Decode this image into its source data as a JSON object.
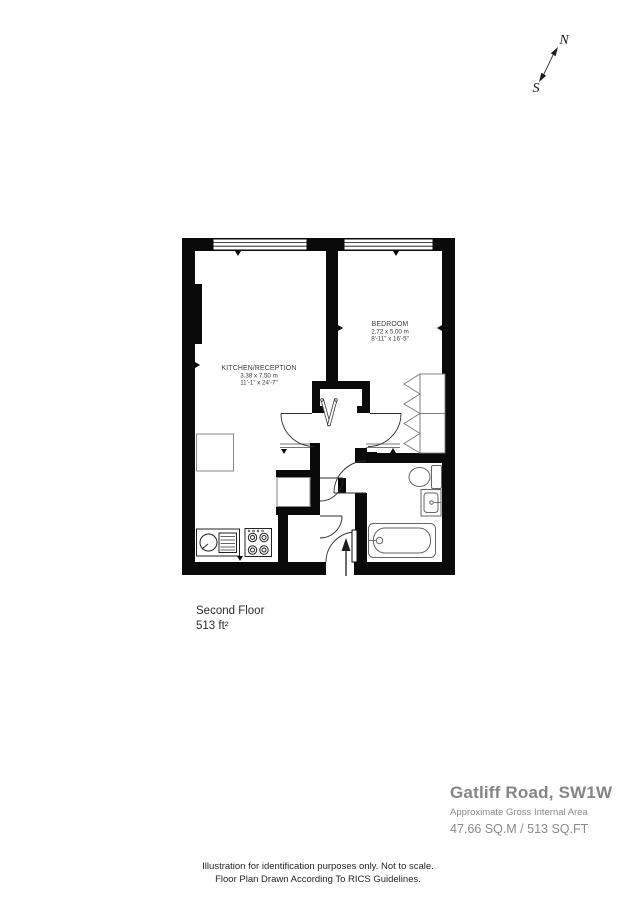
{
  "compass": {
    "north": "N",
    "south": "S"
  },
  "plan": {
    "rooms": [
      {
        "name": "KITCHEN/RECEPTION",
        "size_metric": "3.38 x 7.50 m",
        "size_imperial": "11'-1\" x 24'-7\""
      },
      {
        "name": "BEDROOM",
        "size_metric": "2.72 x 5.00 m",
        "size_imperial": "8'-11\" x 16'-5\""
      }
    ],
    "fixtures": [
      "bath",
      "toilet",
      "basin",
      "kitchen-sink",
      "hob",
      "counter",
      "wardrobe",
      "hanging-rail",
      "entrance-arrow"
    ]
  },
  "floor_label": {
    "name": "Second Floor",
    "area": "513 ft²"
  },
  "summary": {
    "address": "Gatliff Road, SW1W",
    "area_label": "Approximate Gross Internal Area",
    "area_value": "47.66 SQ.M / 513 SQ.FT"
  },
  "disclaimer": {
    "line1": "Illustration for identification purposes only. Not to scale.",
    "line2": "Floor Plan Drawn According To RICS Guidelines."
  },
  "colors": {
    "wall": "#0a0a0a",
    "door_line": "#2e2e2e",
    "fixture_line": "#666666",
    "label_text": "#3a3a3a",
    "heading_text": "#858585"
  }
}
